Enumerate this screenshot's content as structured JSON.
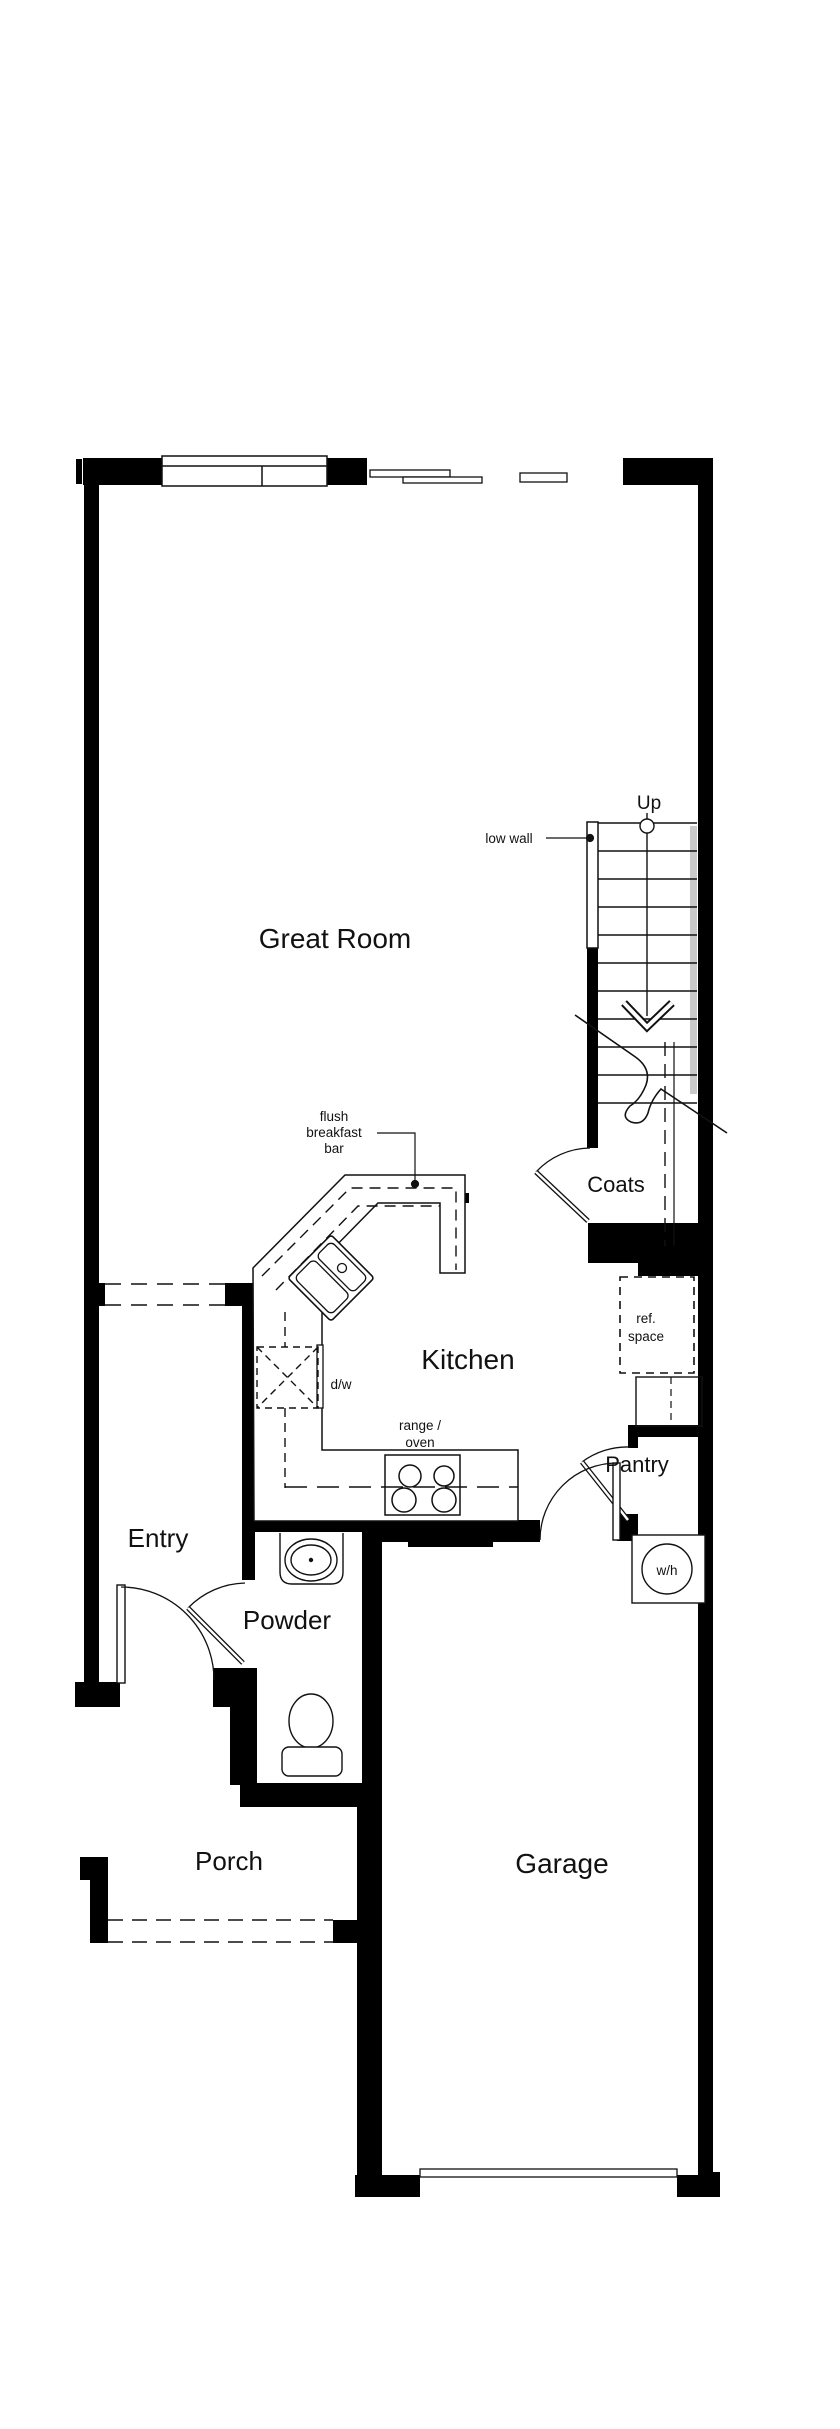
{
  "title": "Residential first-floor plan",
  "colors": {
    "wall": "#000000",
    "background": "#ffffff",
    "rail_gray": "#c9c9c9",
    "line": "#111111"
  },
  "rooms": {
    "great_room": "Great Room",
    "kitchen": "Kitchen",
    "entry": "Entry",
    "powder": "Powder",
    "porch": "Porch",
    "garage": "Garage",
    "coats": "Coats",
    "pantry": "Pantry"
  },
  "annotations": {
    "up": "Up",
    "low_wall": "low wall",
    "flush_breakfast_bar": {
      "lines": [
        "flush",
        "breakfast",
        "bar"
      ]
    },
    "dishwasher": "d/w",
    "range_oven": {
      "lines": [
        "range /",
        "oven"
      ]
    },
    "ref_space": {
      "lines": [
        "ref.",
        "space"
      ]
    },
    "water_heater": "w/h"
  },
  "fixtures": [
    "window",
    "sliding-glass-door",
    "stairs",
    "kitchen-sink",
    "dishwasher",
    "range-oven",
    "refrigerator-space",
    "pantry-shelves",
    "water-heater",
    "bathroom-sink",
    "toilet",
    "front-door",
    "powder-door",
    "coats-door",
    "pantry-door",
    "garage-entry-door",
    "garage-door",
    "porch-steps"
  ]
}
